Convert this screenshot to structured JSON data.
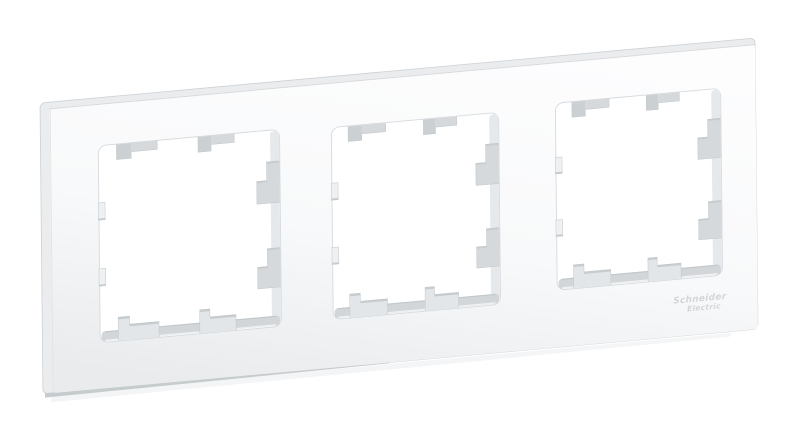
{
  "page": {
    "background_color": "#ffffff",
    "description": "Angled product photo of a white 3-gang wall switch/socket frame on a plain white background"
  },
  "product": {
    "type": "triple frame for switches and sockets",
    "color_name": "white",
    "openings_count": 3,
    "openings": [
      {
        "label": "opening-1"
      },
      {
        "label": "opening-2"
      },
      {
        "label": "opening-3"
      }
    ]
  },
  "logo": {
    "line1": "Schneider",
    "line2": "Electric",
    "color": "#d2d6d9"
  },
  "colors": {
    "background": "#ffffff",
    "face_top": "#fdfdfe",
    "face_mid": "#f8f9fa",
    "face_bottom": "#e9ebed",
    "side": "#eaecee",
    "edge": "#cdd1d4",
    "underside": "#c6cbce",
    "hole_fill": "#ffffff",
    "hole_stroke": "#d6dade",
    "wall_bottom": "#d2d6d9",
    "wall_bottom_edge": "#c2c7ca",
    "wall_right": "#e6e9eb",
    "wall_rim": "#eef0f1",
    "tab": "#d5d9dc",
    "tab_dark": "#cbd0d3",
    "tab_light": "#e3e6e8",
    "tab_cap": "#c7cccf",
    "nub": "#eef0f2",
    "outline": "#c2c7ca"
  }
}
